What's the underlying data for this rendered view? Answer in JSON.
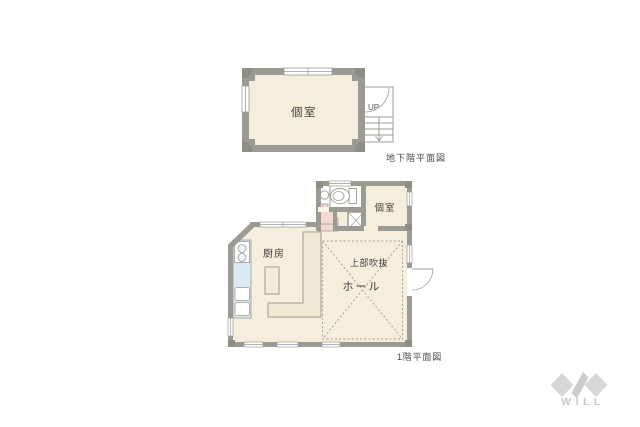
{
  "basement_plan": {
    "caption": "地下階平面図",
    "room_label": "個室",
    "stairs_label": "UP"
  },
  "first_floor_plan": {
    "caption": "1階平面図",
    "kitchen_label": "厨房",
    "room_label": "個室",
    "void_label": "上部吹抜",
    "hall_label": "ホール"
  },
  "logo": {
    "text": "WILL"
  },
  "colors": {
    "wall": "#9b9b94",
    "wall_pillar": "#8e8e87",
    "floor": "#f5eedd",
    "toilet_floor": "#fdfdfb",
    "counter_blue": "#dbe9f3",
    "counter_tan": "#efe8d2",
    "stair_pink": "#f3d8d4",
    "dash_line": "#a39d92",
    "logo_gray": "#d7d7d7"
  }
}
